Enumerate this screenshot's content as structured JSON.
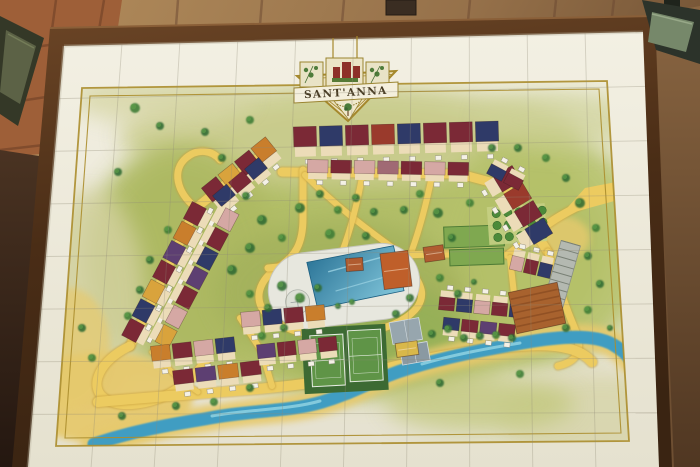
{
  "scene": {
    "setting": "painted ceramic-tile resort site plan in a dark wooden frame on a masonry wall, lit by two wall spotlights",
    "wall_color": "#a5825a",
    "frame_color": "#5a3a1e",
    "tile_color": "#f1eee1",
    "grout_color": "#8f8a76"
  },
  "map": {
    "title": "SANT'ANNA",
    "border_color": "#ab8d2c",
    "palette": {
      "road": "#eccb60",
      "road_edge": "#c9a13c",
      "sand": "#e6c96d",
      "river": "#3f9dc2",
      "river_light": "#8fd2e2",
      "tree_dark": "#2f6a33",
      "tree_alt": "#3d7c36",
      "tree_light": "#5d9c49",
      "wall_chip": "#f4f1e6",
      "facade": "#ecdcb8",
      "roofs": {
        "maroon": "#7b2936",
        "red": "#9a3a2c",
        "orange": "#c97e2c",
        "ochre": "#d9a33c",
        "navy": "#2f3a68",
        "purple": "#5d3f72",
        "pink": "#d5a8a4",
        "mauve": "#a06a74",
        "terracotta": "#b05c30"
      }
    },
    "terrain_blobs": [
      [
        360,
        250,
        250,
        148,
        "#b2be68",
        1
      ],
      [
        350,
        136,
        230,
        52,
        "#cbcd90",
        0.9
      ],
      [
        180,
        258,
        95,
        115,
        "#adb962",
        0.9
      ],
      [
        540,
        248,
        108,
        118,
        "#b5c16b",
        0.9
      ],
      [
        340,
        292,
        125,
        72,
        "#a3b15b",
        0.8
      ],
      [
        372,
        332,
        95,
        48,
        "#90ae55",
        0.7
      ],
      [
        90,
        300,
        55,
        110,
        "#d2d09e",
        0.85
      ],
      [
        600,
        418,
        100,
        45,
        "#d8d5ac",
        0.9
      ],
      [
        480,
        404,
        95,
        28,
        "#c2c87e",
        0.8
      ],
      [
        160,
        98,
        90,
        26,
        "#d6d5a4",
        0.8
      ],
      [
        560,
        120,
        80,
        30,
        "#ccd094",
        0.7
      ]
    ],
    "sand_areas": [
      [
        105,
        398,
        88,
        46,
        0.95
      ],
      [
        70,
        348,
        40,
        60,
        0.7
      ],
      [
        560,
        238,
        30,
        22,
        0.8
      ]
    ],
    "roads": [
      {
        "d": "M268,150 L196,208 L130,346",
        "w": 9
      },
      {
        "d": "M130,346 C100,360 88,386 104,398 C120,410 152,404 172,392 C190,382 200,370 206,360",
        "w": 9
      },
      {
        "d": "M196,208 C176,192 172,170 186,158 C198,148 212,150 220,160",
        "w": 7
      },
      {
        "d": "M282,172 L460,174 L505,186 L548,252",
        "w": 9
      },
      {
        "d": "M303,170 L303,218 C303,244 295,256 280,266",
        "w": 7
      },
      {
        "d": "M280,266 C258,280 252,300 268,316 C290,336 330,340 368,332 C406,324 428,306 420,286 C414,270 398,262 380,258",
        "w": 7
      },
      {
        "d": "M305,175 C335,205 365,228 396,250",
        "w": 6
      },
      {
        "d": "M363,172 C358,200 352,226 342,252",
        "w": 6
      },
      {
        "d": "M432,176 C426,205 420,228 412,250",
        "w": 6
      },
      {
        "d": "M268,268 L330,262 C370,256 420,252 508,255",
        "w": 7
      },
      {
        "d": "M612,192 C580,204 562,214 548,224 L508,255",
        "w": 8
      },
      {
        "d": "M548,252 C556,280 566,308 576,332 C583,352 576,362 558,366",
        "w": 7
      },
      {
        "d": "M98,402 C160,396 230,392 268,388 C320,383 356,376 396,366 C436,356 470,350 520,346 C556,343 580,348 592,362",
        "w": 10
      },
      {
        "d": "M240,318 L262,352 L272,386",
        "w": 6
      },
      {
        "d": "M152,352 L178,378 L198,392",
        "w": 5
      },
      {
        "d": "M345,378 L347,394",
        "w": 5
      },
      {
        "d": "M510,258 L516,312",
        "w": 6
      },
      {
        "d": "M335,338 L340,372",
        "w": 5
      }
    ],
    "entrance_flare": [
      [
        585,
        188
      ],
      [
        616,
        182
      ],
      [
        618,
        200
      ],
      [
        560,
        216
      ]
    ],
    "river": {
      "d": "M94,444 C140,429 175,424 210,418 C252,410 288,412 322,402 C356,392 376,378 410,368 C446,357 482,350 522,343 C560,336 594,334 612,344 C622,350 627,354 630,360",
      "sand_w": 26,
      "w": 13,
      "highlights": [
        "M212,416 C250,409 288,410 320,401",
        "M422,364 C452,355 484,349 520,343"
      ]
    },
    "pool": {
      "deck": {
        "x": 268,
        "y": 248,
        "w": 152,
        "h": 76,
        "r": 38,
        "rot": -7,
        "fill": "#e7e7de"
      },
      "water": [
        [
          310,
          258
        ],
        [
          398,
          252
        ],
        [
          403,
          298
        ],
        [
          315,
          305
        ]
      ],
      "kids": {
        "cx": 296,
        "cy": 296,
        "r": 12
      }
    },
    "tennis": {
      "rot": -3,
      "cx": 345,
      "cy": 358,
      "block": [
        303,
        326,
        84,
        66
      ],
      "block_fill": "#3c6a33",
      "courts": [
        [
          311,
          334,
          33,
          51
        ],
        [
          349,
          331,
          33,
          51
        ]
      ],
      "court_fill": "#5f9447"
    },
    "gray_courts": {
      "rot": -10,
      "cx": 406,
      "cy": 332,
      "rects": [
        [
          391,
          320,
          30,
          22,
          "#97a6ae"
        ],
        [
          397,
          345,
          28,
          19,
          "#8a99a2"
        ]
      ]
    },
    "fields": {
      "rot": -2,
      "cx": 474,
      "cy": 237,
      "rects": [
        [
          444,
          226,
          60,
          21
        ],
        [
          449,
          249,
          54,
          16
        ]
      ],
      "fill": "#7fa850",
      "stroke": "#4c7a34"
    },
    "orchard": {
      "rot": -4,
      "cx": 518,
      "cy": 224,
      "bg": [
        488,
        205,
        58,
        38
      ],
      "bg_fill": "#c5cf83",
      "rows": 3,
      "cols": 5,
      "x0": 497,
      "y0": 212,
      "dx": 11.5,
      "dy": 12,
      "r": 4.2,
      "fill": "#4c8a3a"
    },
    "parking": {
      "rot": 16,
      "cx": 562,
      "cy": 274,
      "rect": [
        552,
        242,
        20,
        64
      ],
      "fill": "#b4b9b1",
      "rungs": 8,
      "line": "#798075"
    },
    "building_rows": [
      {
        "a": [
          292,
          137
        ],
        "b": [
          500,
          131
        ],
        "n": 8,
        "d": 20,
        "side": 1,
        "colors": [
          "maroon",
          "navy",
          "maroon",
          "red",
          "navy",
          "maroon",
          "maroon",
          "navy"
        ]
      },
      {
        "a": [
          306,
          166
        ],
        "b": [
          470,
          169
        ],
        "n": 7,
        "d": 13,
        "side": 1,
        "colors": [
          "pink",
          "maroon",
          "pink",
          "mauve",
          "maroon",
          "pink",
          "maroon"
        ]
      },
      {
        "a": [
          272,
          143
        ],
        "b": [
          206,
          196
        ],
        "n": 4,
        "d": 18,
        "side": -1,
        "colors": [
          "orange",
          "maroon",
          "ochre",
          "maroon"
        ]
      },
      {
        "a": [
          264,
          162
        ],
        "b": [
          216,
          202
        ],
        "n": 3,
        "d": 14,
        "side": -1,
        "colors": [
          "navy",
          "maroon",
          "navy"
        ]
      },
      {
        "a": [
          200,
          204
        ],
        "b": [
          128,
          340
        ],
        "n": 7,
        "d": 16,
        "side": -1,
        "colors": [
          "maroon",
          "orange",
          "purple",
          "maroon",
          "ochre",
          "navy",
          "maroon"
        ]
      },
      {
        "a": [
          233,
          210
        ],
        "b": [
          161,
          346
        ],
        "n": 7,
        "d": 15,
        "side": 1,
        "colors": [
          "pink",
          "maroon",
          "navy",
          "purple",
          "maroon",
          "pink",
          "ochre"
        ]
      },
      {
        "a": [
          150,
          354
        ],
        "b": [
          236,
          344
        ],
        "n": 4,
        "d": 15,
        "side": 1,
        "colors": [
          "orange",
          "maroon",
          "pink",
          "navy"
        ]
      },
      {
        "a": [
          172,
          378
        ],
        "b": [
          262,
          367
        ],
        "n": 4,
        "d": 14,
        "side": 1,
        "colors": [
          "maroon",
          "purple",
          "orange",
          "maroon"
        ]
      },
      {
        "a": [
          240,
          320
        ],
        "b": [
          326,
          312
        ],
        "n": 4,
        "d": 15,
        "side": 1,
        "colors": [
          "pink",
          "navy",
          "maroon",
          "orange"
        ]
      },
      {
        "a": [
          256,
          352
        ],
        "b": [
          338,
          343
        ],
        "n": 4,
        "d": 14,
        "side": 1,
        "colors": [
          "purple",
          "maroon",
          "pink",
          "maroon"
        ]
      },
      {
        "a": [
          502,
          170
        ],
        "b": [
          544,
          240
        ],
        "n": 4,
        "d": 22,
        "side": 1,
        "colors": [
          "maroon",
          "red",
          "maroon",
          "navy"
        ]
      },
      {
        "a": [
          510,
          262
        ],
        "b": [
          552,
          272
        ],
        "n": 3,
        "d": 14,
        "side": -1,
        "colors": [
          "pink",
          "maroon",
          "navy"
        ]
      },
      {
        "a": [
          438,
          303
        ],
        "b": [
          526,
          312
        ],
        "n": 5,
        "d": 13,
        "side": -1,
        "colors": [
          "maroon",
          "navy",
          "pink",
          "maroon",
          "navy"
        ]
      },
      {
        "a": [
          442,
          323
        ],
        "b": [
          516,
          331
        ],
        "n": 4,
        "d": 12,
        "side": 1,
        "colors": [
          "navy",
          "maroon",
          "purple",
          "maroon"
        ]
      },
      {
        "a": [
          488,
          168
        ],
        "b": [
          522,
          186
        ],
        "n": 2,
        "d": 11,
        "side": -1,
        "colors": [
          "navy",
          "maroon"
        ]
      }
    ],
    "buildings": [
      {
        "x": 512,
        "y": 287,
        "w": 50,
        "h": 42,
        "rot": -12,
        "fill": "#a8622e",
        "stripes": 6
      },
      {
        "x": 382,
        "y": 252,
        "w": 28,
        "h": 36,
        "rot": -7,
        "fill": "#bf5f2a"
      },
      {
        "x": 424,
        "y": 246,
        "w": 20,
        "h": 15,
        "rot": -8,
        "fill": "#b05c30"
      },
      {
        "x": 346,
        "y": 258,
        "w": 17,
        "h": 13,
        "rot": -4,
        "fill": "#b05c30"
      },
      {
        "x": 396,
        "y": 342,
        "w": 22,
        "h": 14,
        "rot": -8,
        "fill": "#d9b84a"
      }
    ],
    "trees": [
      [
        135,
        108,
        5
      ],
      [
        160,
        126,
        4
      ],
      [
        118,
        172,
        4
      ],
      [
        250,
        120,
        4
      ],
      [
        222,
        158,
        4
      ],
      [
        205,
        132,
        4
      ],
      [
        168,
        230,
        4
      ],
      [
        150,
        260,
        4
      ],
      [
        140,
        290,
        4
      ],
      [
        128,
        316,
        4
      ],
      [
        246,
        196,
        4
      ],
      [
        262,
        220,
        5
      ],
      [
        282,
        238,
        4
      ],
      [
        250,
        248,
        5
      ],
      [
        232,
        270,
        5
      ],
      [
        250,
        294,
        4
      ],
      [
        268,
        308,
        4
      ],
      [
        284,
        328,
        4
      ],
      [
        262,
        336,
        4
      ],
      [
        300,
        208,
        5
      ],
      [
        320,
        194,
        4
      ],
      [
        338,
        210,
        4
      ],
      [
        356,
        198,
        4
      ],
      [
        374,
        212,
        4
      ],
      [
        330,
        234,
        5
      ],
      [
        366,
        236,
        4
      ],
      [
        404,
        210,
        4
      ],
      [
        420,
        194,
        4
      ],
      [
        438,
        213,
        5
      ],
      [
        452,
        238,
        4
      ],
      [
        470,
        203,
        4
      ],
      [
        492,
        148,
        4
      ],
      [
        518,
        148,
        4
      ],
      [
        546,
        158,
        4
      ],
      [
        566,
        178,
        4
      ],
      [
        580,
        203,
        5
      ],
      [
        596,
        228,
        4
      ],
      [
        588,
        256,
        4
      ],
      [
        600,
        284,
        4
      ],
      [
        588,
        310,
        4
      ],
      [
        566,
        328,
        4
      ],
      [
        610,
        328,
        3
      ],
      [
        440,
        278,
        4
      ],
      [
        458,
        294,
        4
      ],
      [
        474,
        282,
        3
      ],
      [
        300,
        298,
        5
      ],
      [
        282,
        286,
        5
      ],
      [
        318,
        288,
        4
      ],
      [
        352,
        302,
        3
      ],
      [
        338,
        306,
        3
      ],
      [
        432,
        334,
        4
      ],
      [
        448,
        329,
        4
      ],
      [
        464,
        338,
        4
      ],
      [
        480,
        336,
        4
      ],
      [
        496,
        335,
        4
      ],
      [
        512,
        338,
        4
      ],
      [
        250,
        388,
        4
      ],
      [
        214,
        402,
        4
      ],
      [
        176,
        406,
        4
      ],
      [
        122,
        416,
        4
      ],
      [
        92,
        358,
        4
      ],
      [
        82,
        328,
        4
      ],
      [
        440,
        383,
        4
      ],
      [
        520,
        374,
        4
      ],
      [
        410,
        298,
        4
      ],
      [
        396,
        314,
        4
      ]
    ],
    "border_quads": {
      "outer": [
        [
          82,
          88
        ],
        [
          607,
          81
        ],
        [
          629,
          441
        ],
        [
          56,
          446
        ]
      ],
      "inner": [
        [
          90,
          96
        ],
        [
          599,
          89
        ],
        [
          621,
          433
        ],
        [
          65,
          438
        ]
      ]
    },
    "tile_grid": {
      "quad": [
        [
          64,
          46
        ],
        [
          643,
          32
        ],
        [
          659,
          467
        ],
        [
          28,
          467
        ]
      ],
      "cols": 10,
      "rows": 8
    }
  }
}
